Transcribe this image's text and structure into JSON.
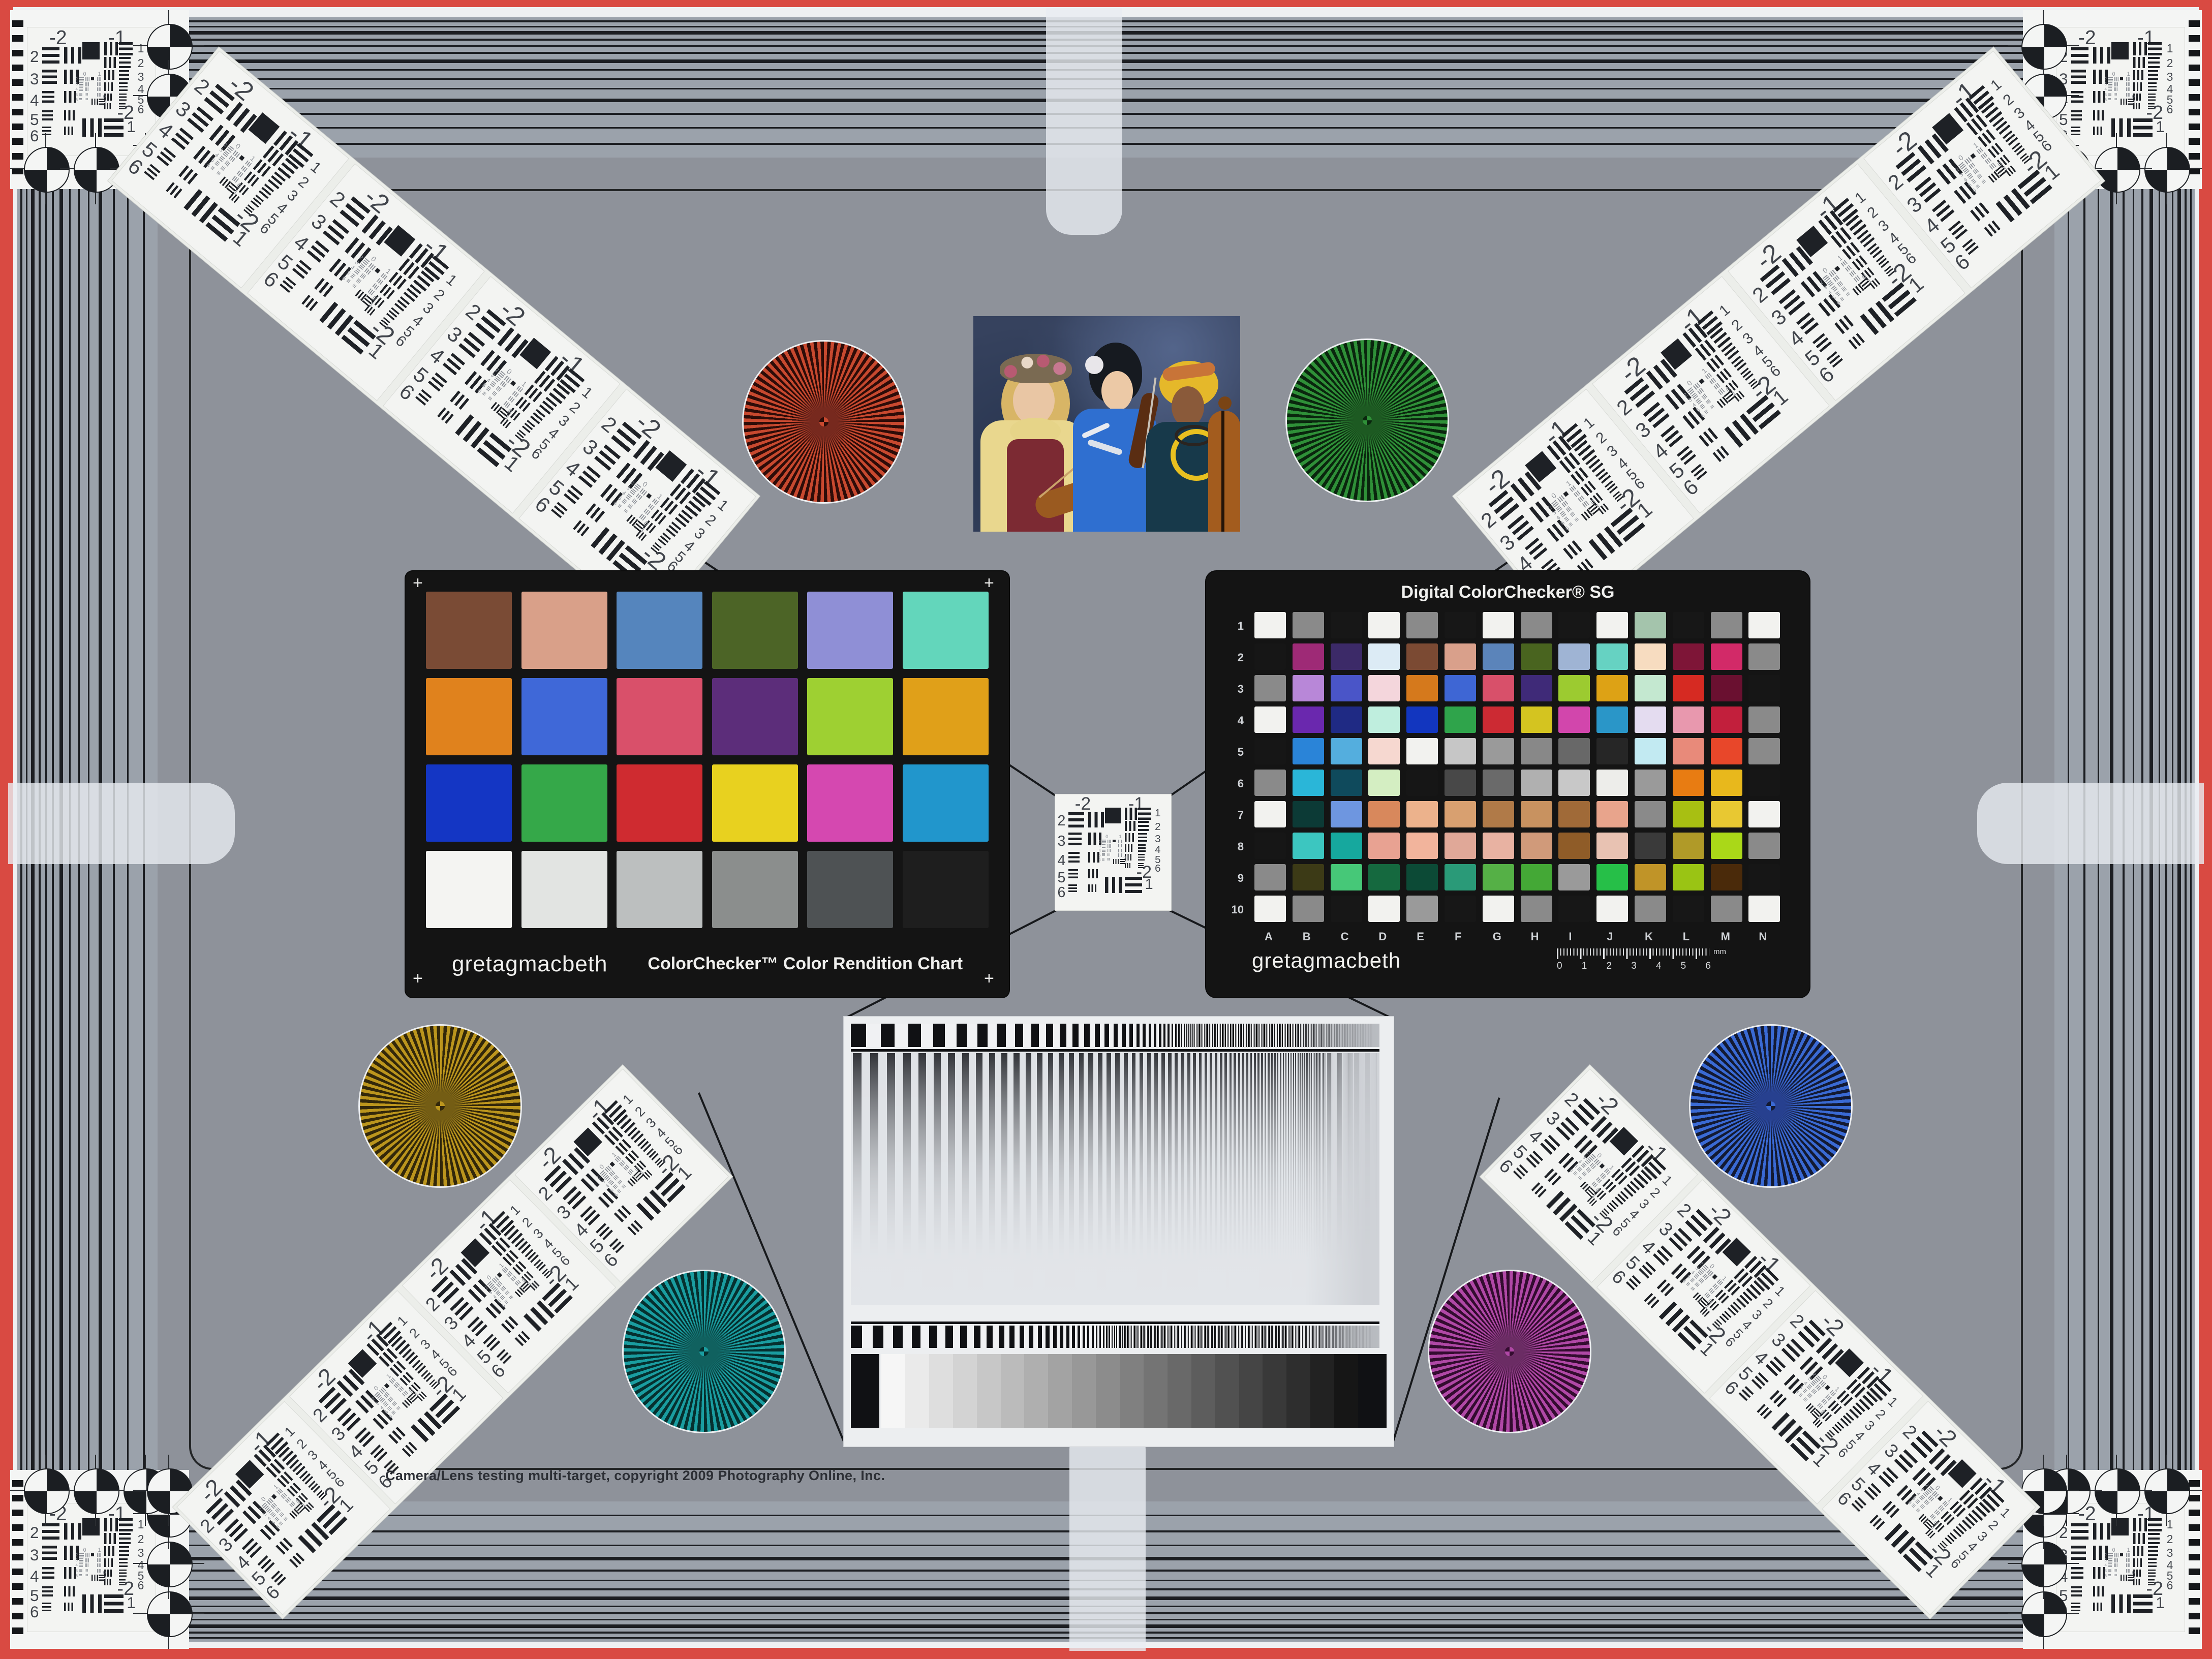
{
  "page": {
    "bg": "#8e929a",
    "band_bg": "#9ba2ab",
    "red_border": "#d94a42",
    "card_black": "#141414",
    "line_color": "#17191c"
  },
  "footer": {
    "copyright": "Camera/Lens testing multi-target, copyright 2009 Photography Online, Inc."
  },
  "classic": {
    "brand": "gretagmacbeth",
    "title": "ColorChecker™ Color Rendition Chart",
    "corner_mark": "+",
    "rows": [
      [
        "#7a4b35",
        "#d9a089",
        "#5585bd",
        "#4c6426",
        "#8f8fd6",
        "#63d6bb"
      ],
      [
        "#e0821d",
        "#3f68d8",
        "#d9506a",
        "#5c2d7a",
        "#9ed032",
        "#e0a019"
      ],
      [
        "#1436c4",
        "#35a849",
        "#cf2b30",
        "#e8d11f",
        "#d548b0",
        "#2196cc"
      ],
      [
        "#f4f4f2",
        "#e2e4e2",
        "#bcbfbf",
        "#8b8e8d",
        "#4e5254",
        "#1e1e1e"
      ]
    ]
  },
  "sg": {
    "title": "Digital ColorChecker® SG",
    "brand": "gretagmacbeth",
    "row_labels": [
      "1",
      "2",
      "3",
      "4",
      "5",
      "6",
      "7",
      "8",
      "9",
      "10"
    ],
    "col_labels": [
      "A",
      "B",
      "C",
      "D",
      "E",
      "F",
      "G",
      "H",
      "I",
      "J",
      "K",
      "L",
      "M",
      "N"
    ],
    "ruler_numbers": [
      "0",
      "1",
      "2",
      "3",
      "4",
      "5",
      "6"
    ],
    "ruler_unit": "mm",
    "rows": [
      [
        "#f2f2ef",
        "#8a8a8a",
        "#171717",
        "#f2f2ef",
        "#8a8a8a",
        "#171717",
        "#f2f2ef",
        "#8a8a8a",
        "#171717",
        "#f2f2ef",
        "#a4c4ac",
        "#171717",
        "#8a8a8a",
        "#f2f2ef"
      ],
      [
        "#161616",
        "#9e2a76",
        "#3c2a68",
        "#dcebf5",
        "#7b4a33",
        "#d9a08b",
        "#5b84ba",
        "#49641f",
        "#9fb4d4",
        "#66d2c2",
        "#f7dcc0",
        "#7e1537",
        "#d22a68",
        "#8a8a8a"
      ],
      [
        "#8a8a8a",
        "#b887d8",
        "#4a55c8",
        "#f4d6dc",
        "#d5791c",
        "#3e66d4",
        "#d8506a",
        "#3f2a78",
        "#9ccb30",
        "#dda215",
        "#c4e8d0",
        "#d62a22",
        "#6a1030",
        "#161616"
      ],
      [
        "#f2f2ef",
        "#6a28ae",
        "#1f2a84",
        "#bfeede",
        "#1236bf",
        "#2fa44b",
        "#cc2a33",
        "#d4c420",
        "#d246ac",
        "#2a96c8",
        "#e4dcf0",
        "#e898ae",
        "#c21f3c",
        "#8a8a8a"
      ],
      [
        "#161616",
        "#2a84d8",
        "#54aede",
        "#f6d8d0",
        "#f2f2ef",
        "#c6c6c6",
        "#9a9a9a",
        "#888888",
        "#686868",
        "#262626",
        "#c2eaf2",
        "#e88a7a",
        "#e8472a",
        "#8a8a8a"
      ],
      [
        "#8a8a8a",
        "#2ab6d8",
        "#0f4a5c",
        "#d4eec2",
        "#161616",
        "#484848",
        "#6a6a6a",
        "#b0b0b0",
        "#c8c8c8",
        "#ededea",
        "#9a9a9a",
        "#e87c12",
        "#e8b81c",
        "#161616"
      ],
      [
        "#f2f2ef",
        "#0c3a36",
        "#6e96e0",
        "#d8885c",
        "#ecb28c",
        "#d8a070",
        "#b07a48",
        "#c89260",
        "#a06a38",
        "#e8a48c",
        "#8a8a8a",
        "#a8bf12",
        "#e8c832",
        "#f2f2ef"
      ],
      [
        "#161616",
        "#3cc6c0",
        "#16a89e",
        "#e8a292",
        "#f2b49c",
        "#e0a898",
        "#e8b2a2",
        "#d09a7a",
        "#8f5c28",
        "#e8c2b2",
        "#3a3a3a",
        "#b09a28",
        "#aad818",
        "#8a8a8a"
      ],
      [
        "#8a8a8a",
        "#3c3a16",
        "#46c878",
        "#15693f",
        "#0c4a36",
        "#2a9a78",
        "#55b046",
        "#44a836",
        "#9a9a9a",
        "#26bf48",
        "#c09428",
        "#9ac414",
        "#4a2a0a",
        "#161616"
      ],
      [
        "#f2f2ef",
        "#8a8a8a",
        "#171717",
        "#f2f2ef",
        "#9a9a9a",
        "#171717",
        "#f2f2ef",
        "#8a8a8a",
        "#171717",
        "#f2f2ef",
        "#8a8a8a",
        "#171717",
        "#8a8a8a",
        "#f2f2ef"
      ]
    ]
  },
  "usaf": {
    "top_labels": [
      "-2",
      "-1"
    ],
    "left_numbers": [
      "2",
      "3",
      "4",
      "5",
      "6"
    ],
    "right_numbers": [
      "1",
      "2",
      "3",
      "4",
      "5",
      "6"
    ],
    "micro_top": [
      "0",
      "1"
    ],
    "micro_numbers": [
      "2",
      "3",
      "4",
      "5",
      "6"
    ],
    "bottom_labels": [
      "-2",
      "1"
    ]
  },
  "stars": [
    {
      "name": "red-star",
      "bright": "#c8492f",
      "mid": "#77291e",
      "dark": "#2e0c08"
    },
    {
      "name": "green-star",
      "bright": "#2f9038",
      "mid": "#1d5a22",
      "dark": "#0a260e"
    },
    {
      "name": "olive-star",
      "bright": "#bb951d",
      "mid": "#745d14",
      "dark": "#33280a"
    },
    {
      "name": "blue-star",
      "bright": "#3a6ad4",
      "mid": "#27408f",
      "dark": "#131a33"
    },
    {
      "name": "teal-star",
      "bright": "#1a9da0",
      "mid": "#10615f",
      "dark": "#06302f"
    },
    {
      "name": "magenta-star",
      "bright": "#b048a6",
      "mid": "#6b2c64",
      "dark": "#330c2f"
    }
  ],
  "gray_wedge": {
    "steps": 20,
    "from_value": 246,
    "to_value": 22
  },
  "photo": {
    "palette": {
      "background": "#36425e",
      "blouse_yellow": "#e9d78e",
      "vest_red": "#7c2a33",
      "collar_yellow": "#e6d488",
      "kimono_blue": "#2f6fd0",
      "headwrap_yellow": "#e5b82a",
      "outfit_teal": "#17394a",
      "skin_light": "#e9c6a4",
      "skin_medium": "#ecc9a6",
      "skin_dark": "#8a5a3a",
      "hair_blonde": "#d8b566",
      "hair_black": "#161a20",
      "violin_brown": "#9a5a20",
      "cello_brown": "#a35c1e",
      "flower_white": "#e8e6ea",
      "flower_pink": "#b85a72",
      "necklace_yellow": "#e8c020"
    }
  }
}
